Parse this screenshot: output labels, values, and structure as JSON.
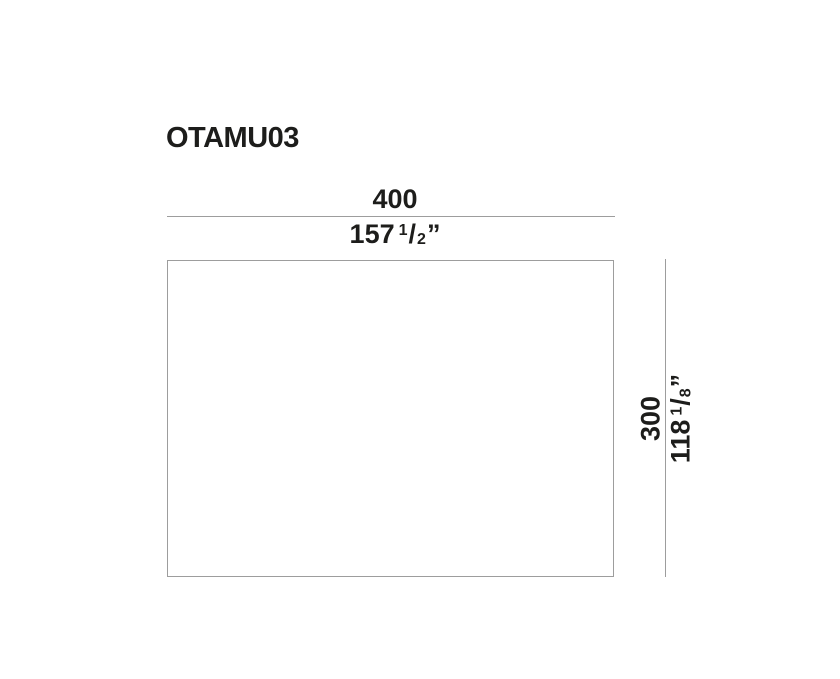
{
  "drawing": {
    "product_code": "OTAMU03",
    "width": {
      "metric": "400",
      "imperial_whole": "157",
      "frac_numerator": "1",
      "frac_slash": "/",
      "frac_denominator": "2",
      "unit_mark": "”"
    },
    "height": {
      "metric": "300",
      "imperial_whole": "118",
      "frac_numerator": "1",
      "frac_slash": "/",
      "frac_denominator": "8",
      "unit_mark": "”"
    },
    "colors": {
      "text": "#1d1d1b",
      "line": "#9d9d9d",
      "background": "#ffffff"
    }
  }
}
